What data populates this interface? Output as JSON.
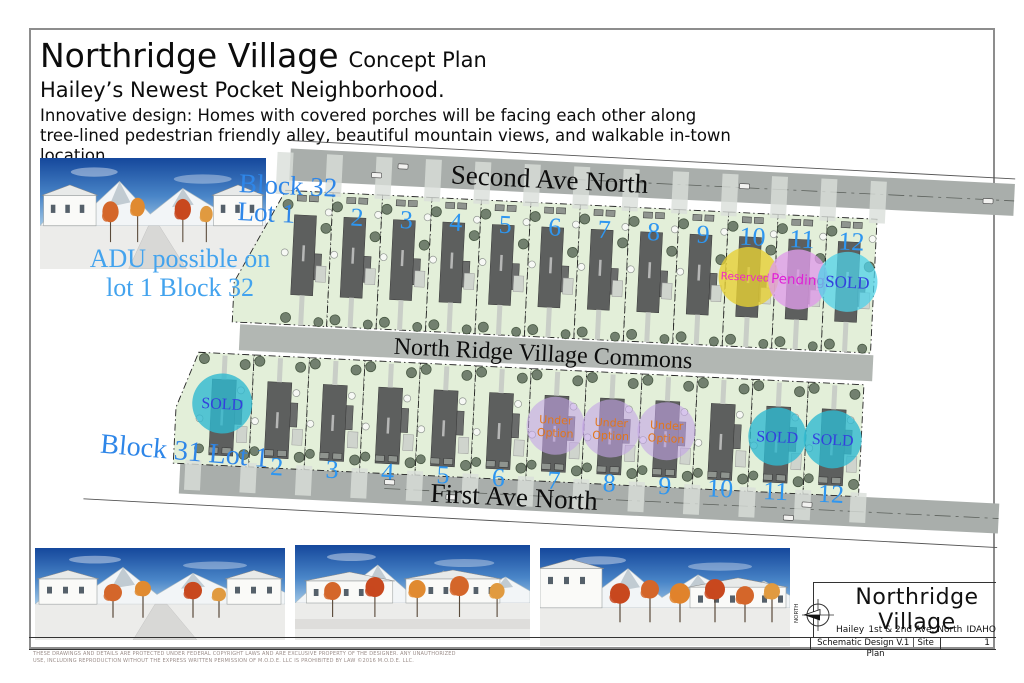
{
  "header": {
    "title": "Northridge Village",
    "title_suffix": "Concept Plan",
    "subtitle": "Hailey’s Newest Pocket Neighborhood.",
    "description_line1": "Innovative design: Homes with covered porches will be facing each other along",
    "description_line2": "tree-lined pedestrian friendly alley, beautiful mountain views, and walkable in-town location."
  },
  "annotations": {
    "adu_line1": "ADU possible on",
    "adu_line2": "lot 1 Block 32",
    "block32_line1": "Block 32",
    "block32_line2": "Lot 1",
    "block31_label": "Block 31 Lot 1"
  },
  "streets": {
    "top": "Second Ave North",
    "middle": "North Ridge Village Commons",
    "bottom": "First Ave North"
  },
  "status_colors": {
    "sold_fill": "#2fb9cf",
    "sold_fill_bright": "#4fd2e8",
    "sold_text": "#3340dd",
    "reserved_fill": "#e6cf35",
    "reserved_text": "#f322c6",
    "pending_fill": "#de9ce8",
    "pending_text": "#e021d6",
    "under_option_fill": "#c3a4e6",
    "under_option_text": "#e2761c",
    "lot_number_blue": "#2e96f0",
    "label_blue": "#2e86e8"
  },
  "plan": {
    "block32": {
      "name": "Block 32",
      "lots": [
        {
          "number": "1",
          "status": null,
          "status_label": null
        },
        {
          "number": "2",
          "status": null,
          "status_label": null
        },
        {
          "number": "3",
          "status": null,
          "status_label": null
        },
        {
          "number": "4",
          "status": null,
          "status_label": null
        },
        {
          "number": "5",
          "status": null,
          "status_label": null
        },
        {
          "number": "6",
          "status": null,
          "status_label": null
        },
        {
          "number": "7",
          "status": null,
          "status_label": null
        },
        {
          "number": "8",
          "status": null,
          "status_label": null
        },
        {
          "number": "9",
          "status": null,
          "status_label": null
        },
        {
          "number": "10",
          "status": "reserved",
          "status_label": "Reserved :"
        },
        {
          "number": "11",
          "status": "pending",
          "status_label": "Pending"
        },
        {
          "number": "12",
          "status": "sold_bright",
          "status_label": "SOLD"
        }
      ]
    },
    "block31": {
      "name": "Block 31",
      "lots": [
        {
          "number": "1",
          "status": "sold",
          "status_label": "SOLD"
        },
        {
          "number": "2",
          "status": null,
          "status_label": null
        },
        {
          "number": "3",
          "status": null,
          "status_label": null
        },
        {
          "number": "4",
          "status": null,
          "status_label": null
        },
        {
          "number": "5",
          "status": null,
          "status_label": null
        },
        {
          "number": "6",
          "status": null,
          "status_label": null
        },
        {
          "number": "7",
          "status": "under_option",
          "status_label": "Under Option"
        },
        {
          "number": "8",
          "status": "under_option",
          "status_label": "Under Option"
        },
        {
          "number": "9",
          "status": "under_option",
          "status_label": "Under Option"
        },
        {
          "number": "10",
          "status": null,
          "status_label": null
        },
        {
          "number": "11",
          "status": "sold",
          "status_label": "SOLD"
        },
        {
          "number": "12",
          "status": "sold",
          "status_label": "SOLD"
        }
      ]
    }
  },
  "title_block": {
    "project": "Northridge Village",
    "city": "Hailey",
    "address": "1st & 2nd Ave. North",
    "state": "IDAHO",
    "sheet_title": "Schematic Design V.1 | Site Plan",
    "sheet_number": "1",
    "north_label": "NORTH"
  },
  "footer": {
    "copyright_line1": "THESE DRAWINGS AND DETAILS ARE PROTECTED UNDER FEDERAL COPYRIGHT LAWS AND ARE EXCLUSIVE PROPERTY OF THE DESIGNER.  ANY UNAUTHORIZED",
    "copyright_line2": "USE, INCLUDING REPRODUCTION WITHOUT THE EXPRESS WRITTEN PERMISSION OF M.O.D.E. LLC IS PROHIBITED BY LAW ©2016  M.O.D.E. LLC."
  }
}
